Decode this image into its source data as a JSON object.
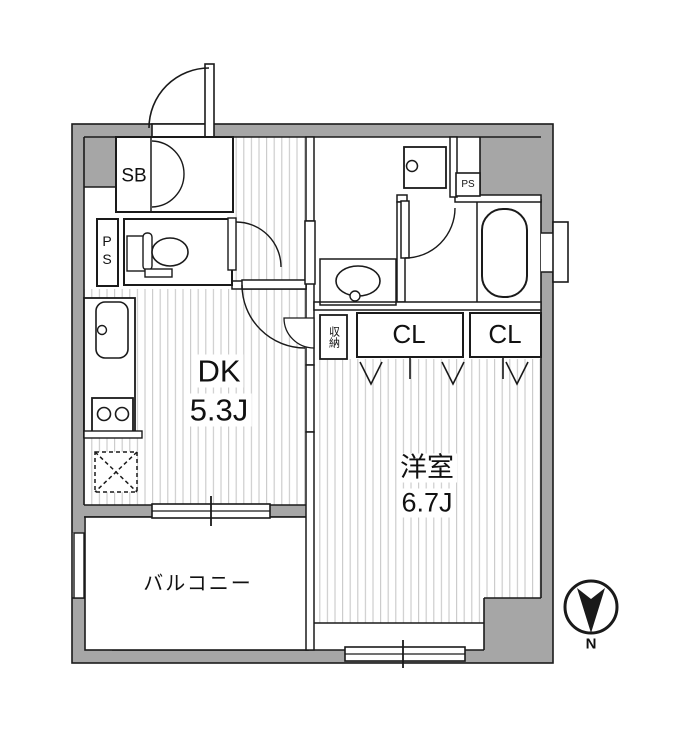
{
  "title": "1DK apartment floor plan",
  "compass": {
    "label": "N",
    "direction": "down"
  },
  "rooms": [
    {
      "name": "dining-kitchen",
      "label": "DK",
      "size": "5.3J"
    },
    {
      "name": "western-room",
      "label": "洋室",
      "size": "6.7J"
    },
    {
      "name": "balcony",
      "label": "バルコニー",
      "size": ""
    }
  ],
  "closets": [
    {
      "name": "shoe-box",
      "label": "SB"
    },
    {
      "name": "closet-1",
      "label": "CL"
    },
    {
      "name": "closet-2",
      "label": "CL"
    },
    {
      "name": "storage",
      "label": "収納"
    }
  ],
  "utilities": [
    {
      "name": "pipe-space-west",
      "label": "PS"
    },
    {
      "name": "pipe-space-north",
      "label": "PS"
    }
  ],
  "fixtures": [
    {
      "name": "entrance-door"
    },
    {
      "name": "shoe-box-double-doors"
    },
    {
      "name": "toilet"
    },
    {
      "name": "kitchen-sink"
    },
    {
      "name": "gas-stove-2-burner"
    },
    {
      "name": "refrigerator-space"
    },
    {
      "name": "wash-basin"
    },
    {
      "name": "washing-machine-pan"
    },
    {
      "name": "bathtub"
    },
    {
      "name": "sliding-window-dk"
    },
    {
      "name": "sliding-window-south"
    },
    {
      "name": "wall-vent-east"
    }
  ],
  "colors": {
    "wall_gray": "#a6a6a6",
    "line_black": "#1a1a1a",
    "hatch_gray": "#c9c9c9",
    "background": "#ffffff"
  }
}
